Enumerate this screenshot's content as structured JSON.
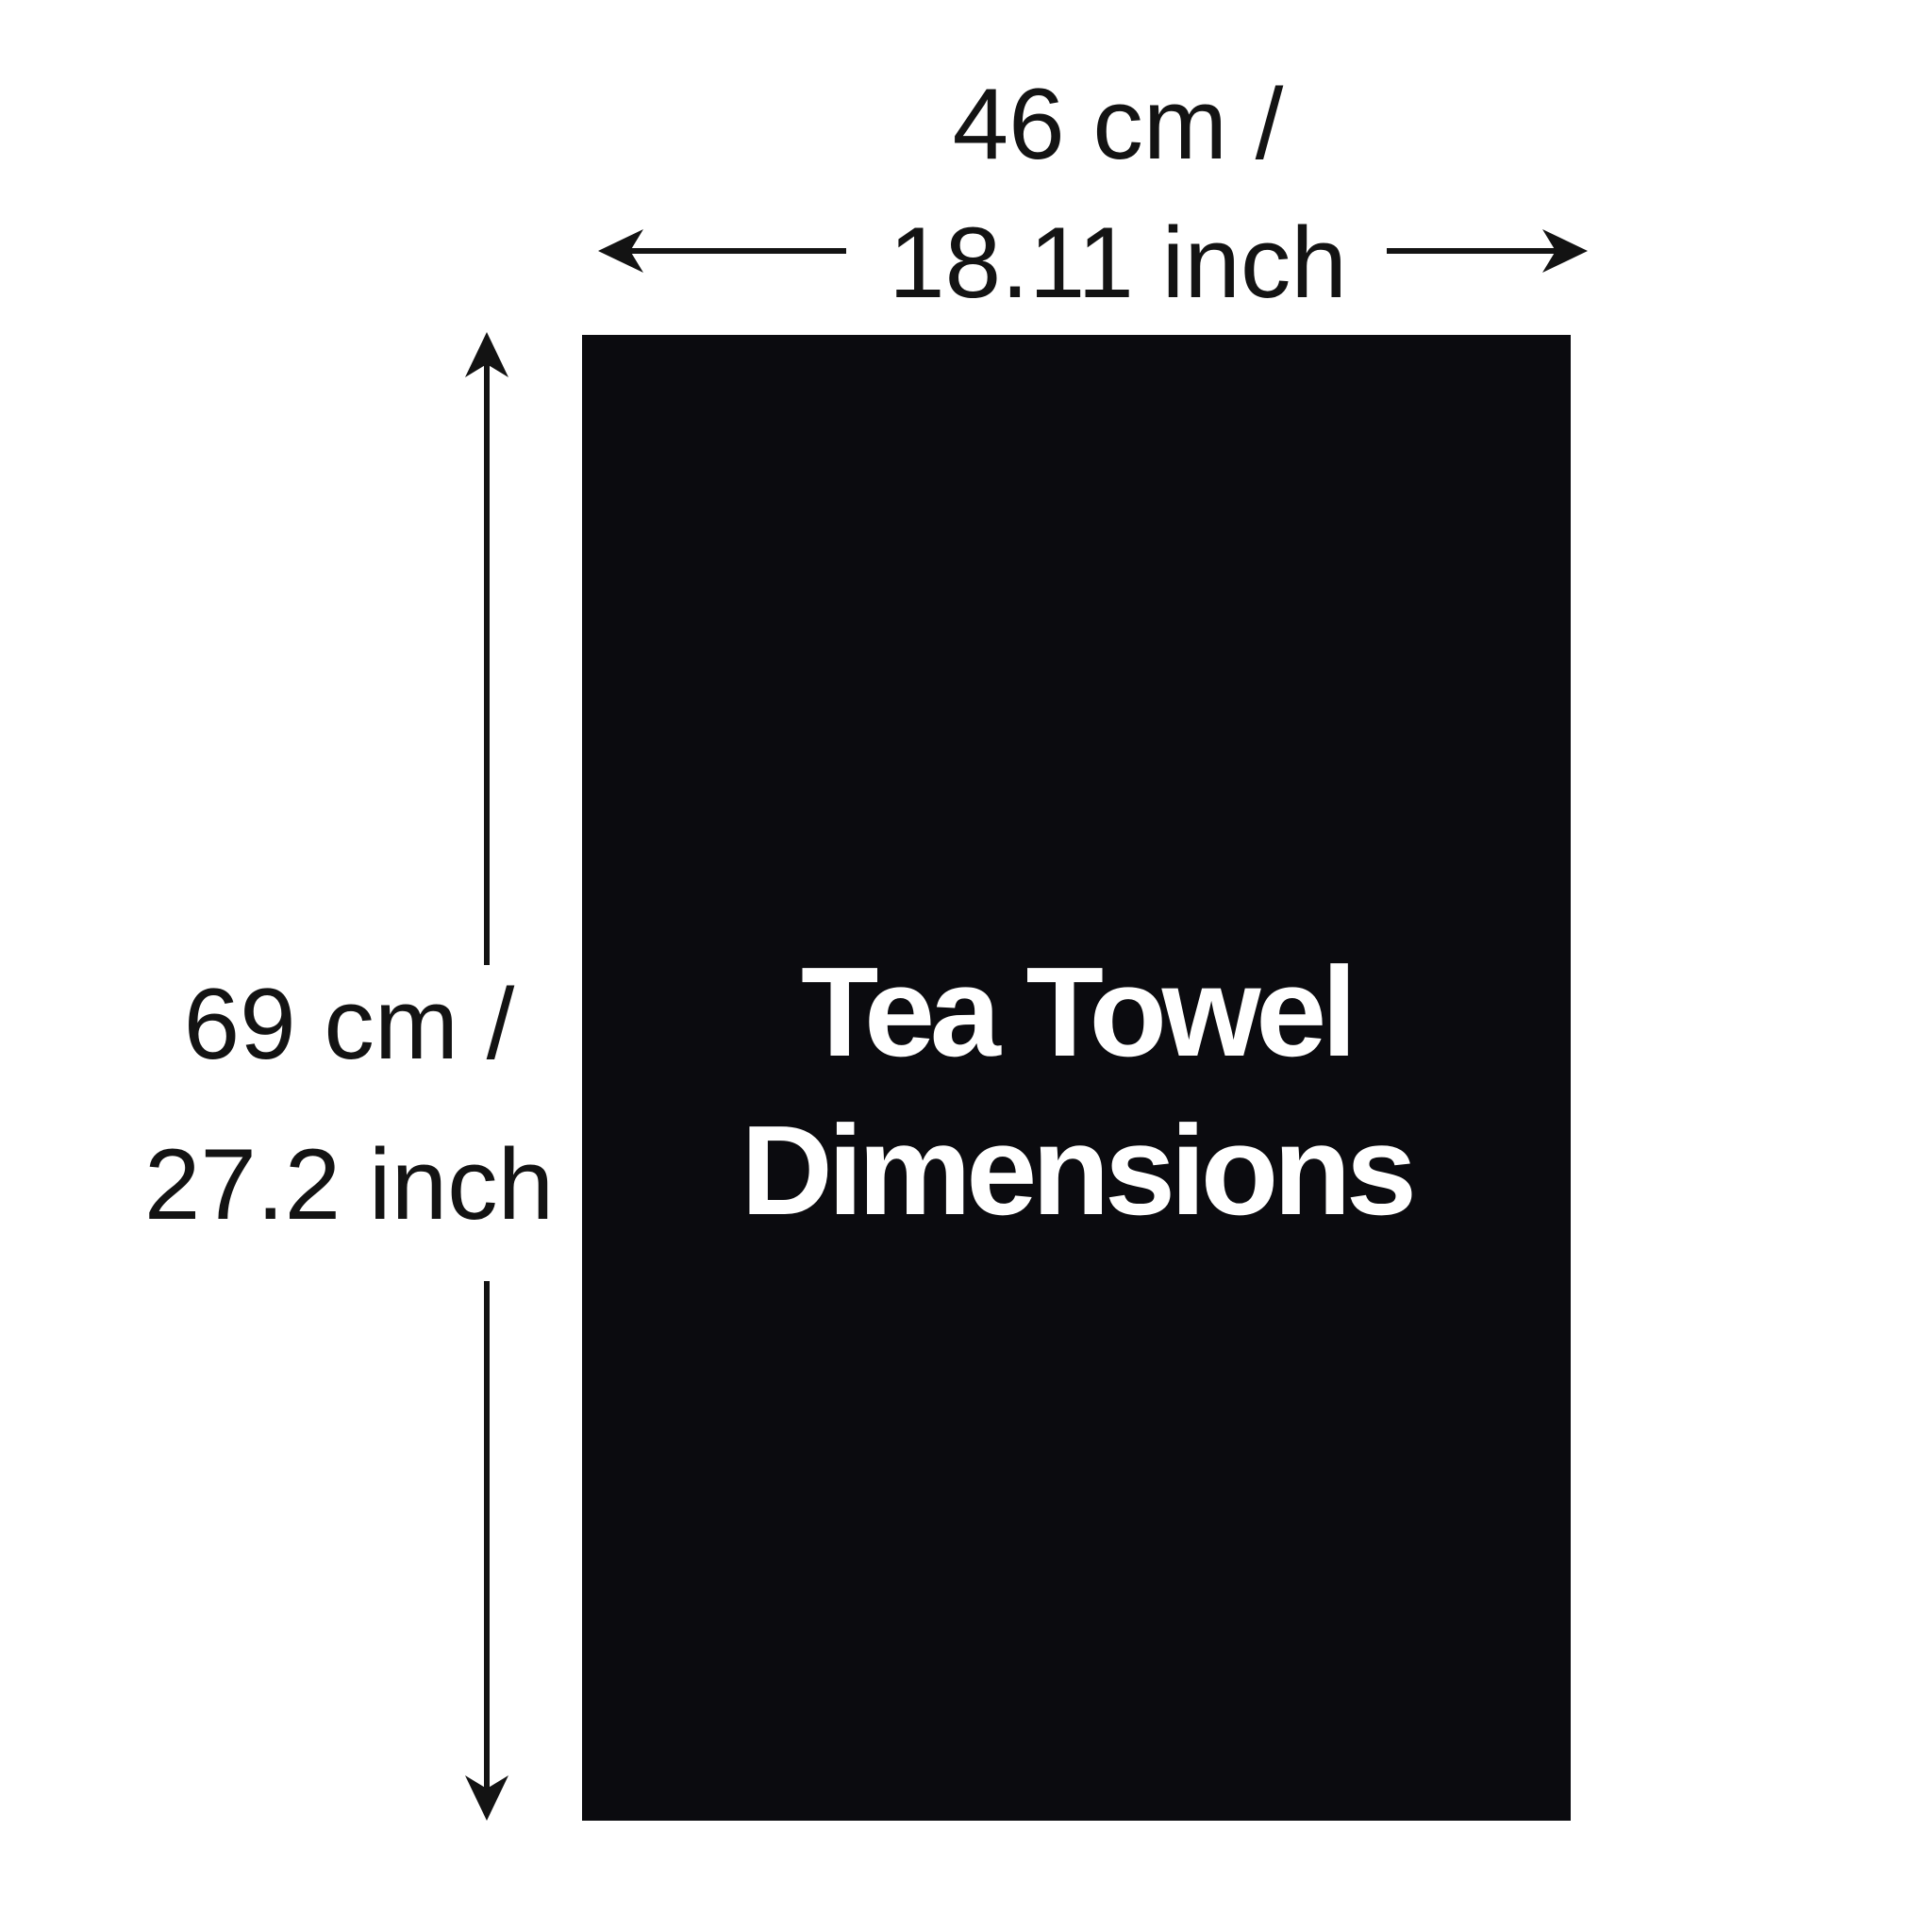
{
  "diagram": {
    "towel": {
      "title_line1": "Tea Towel",
      "title_line2": "Dimensions"
    },
    "width_dimension": {
      "line1": "46 cm /",
      "line2": "18.11 inch"
    },
    "height_dimension": {
      "line1": "69 cm /",
      "line2": "27.2 inch"
    }
  },
  "colors": {
    "background": "#ffffff",
    "towel_fill": "#0b0b0f",
    "title_text": "#ffffff",
    "label_text": "#131313",
    "arrow": "#131313"
  }
}
